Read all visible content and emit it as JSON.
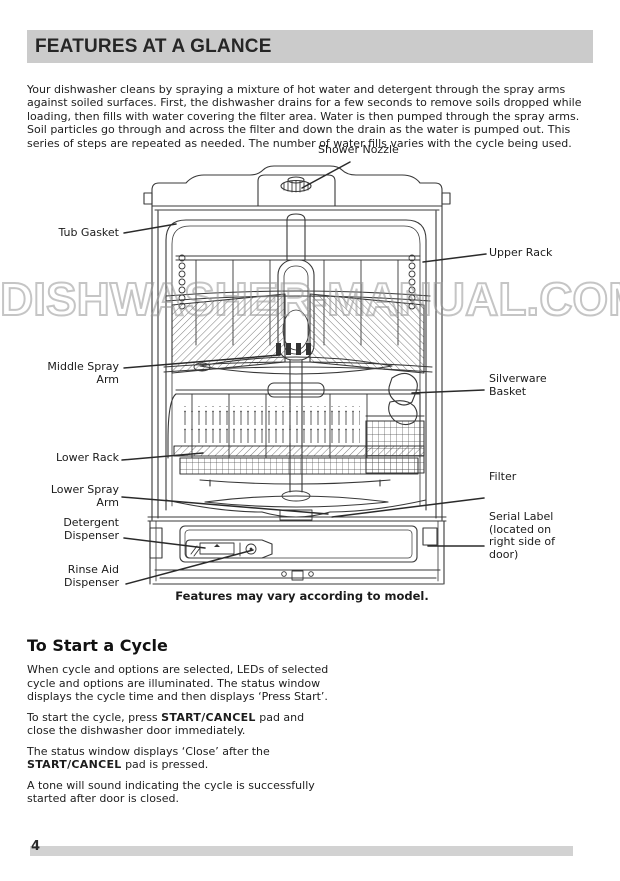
{
  "page": {
    "number": "4",
    "watermark": "DISHWASHER-MANUAL.COM"
  },
  "header": {
    "title": "FEATURES AT A GLANCE"
  },
  "intro": {
    "text": "Your dishwasher cleans by spraying a mixture of hot water and detergent through the spray arms against soiled surfaces. First, the dishwasher drains for a few seconds to remove soils dropped while loading, then fills with water covering the filter area. Water is then pumped through the spray arms. Soil particles go through and across the filter and down the drain as the water is pumped out. This series of steps are repeated as needed. The number of water fills varies with the cycle being used."
  },
  "diagram": {
    "caption": "Features may vary according to model.",
    "labels": {
      "shower_nozzle": "Shower Nozzle",
      "tub_gasket": "Tub Gasket",
      "upper_rack": "Upper Rack",
      "middle_spray_arm": "Middle Spray\nArm",
      "silverware_basket": "Silverware\nBasket",
      "lower_rack": "Lower Rack",
      "filter": "Filter",
      "lower_spray_arm": "Lower Spray\nArm",
      "serial_label": "Serial Label\n(located on\nright side of\ndoor)",
      "detergent_dispenser": "Detergent\nDispenser",
      "rinse_aid_dispenser": "Rinse Aid\nDispenser"
    }
  },
  "start_cycle": {
    "heading": "To Start a Cycle",
    "paragraphs": [
      [
        {
          "t": "When cycle and options are selected, LEDs of selected cycle and options are illuminated. The status window displays the cycle time and then displays ‘Press Start’.",
          "b": false
        }
      ],
      [
        {
          "t": "To start the cycle, press ",
          "b": false
        },
        {
          "t": "START/CANCEL",
          "b": true
        },
        {
          "t": " pad and close the dishwasher door immediately.",
          "b": false
        }
      ],
      [
        {
          "t": "The status window displays ‘Close’ after the ",
          "b": false
        },
        {
          "t": "START/CANCEL",
          "b": true
        },
        {
          "t": " pad is pressed.",
          "b": false
        }
      ],
      [
        {
          "t": "A tone will sound indicating the cycle is successfully started after door is closed.",
          "b": false
        }
      ]
    ]
  }
}
